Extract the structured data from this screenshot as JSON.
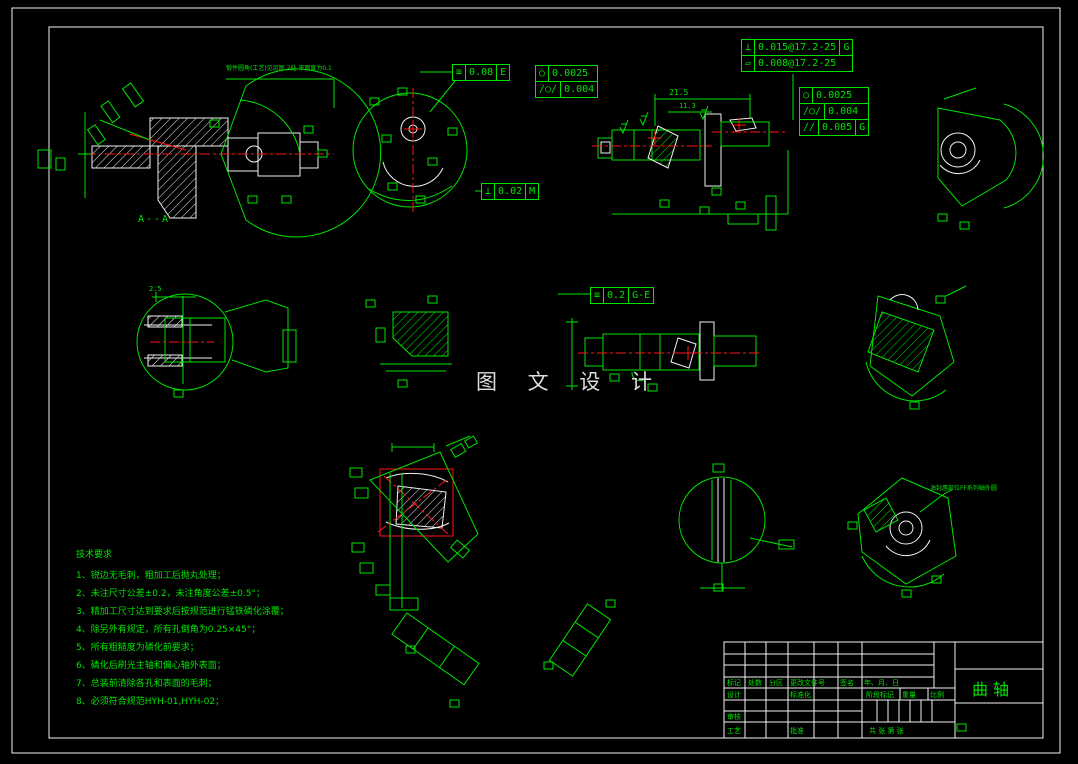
{
  "colors": {
    "background": "#000000",
    "sheet_frame": "#ffffff",
    "line_green": "#00e400",
    "accent_red": "#ff1414",
    "detail_white": "#f2f2f2",
    "watermark_gray": "#dedede"
  },
  "watermark": {
    "text": "图 文 设 计"
  },
  "labels": {
    "section": "A--A"
  },
  "dims": {
    "d1": "21.5",
    "d2": "11.3",
    "d3": "2.5"
  },
  "annotations": {
    "forging_note": "锻件圆角(工艺)见另图 2处 平面度为0.1",
    "seal_note": "油封唇部位FF系列轴外圆"
  },
  "tolerance_frames": {
    "sym008": {
      "symbol": "≡",
      "value": "0.08",
      "datum": "E"
    },
    "perp002": {
      "symbol": "⊥",
      "value": "0.02",
      "datum": "M"
    },
    "circ1": {
      "symbol": "○",
      "value": "0.0025"
    },
    "cyl1": {
      "symbol": "/○/",
      "value": "0.004"
    },
    "perp0015": {
      "symbol": "⊥",
      "value": "0.015@17.2-25",
      "datum": "G"
    },
    "flat0008": {
      "symbol": "▱",
      "value": "0.008@17.2-25"
    },
    "circ2": {
      "symbol": "○",
      "value": "0.0025"
    },
    "cyl2": {
      "symbol": "/○/",
      "value": "0.004"
    },
    "par0005": {
      "symbol": "//",
      "value": "0.005",
      "datum": "G"
    },
    "sym02": {
      "symbol": "≡",
      "value": "0.2",
      "datum": "G-E"
    }
  },
  "tech_requirements": {
    "title": "技术要求",
    "items": [
      "1、锐边无毛刺，粗加工后抛丸处理；",
      "2、未注尺寸公差±0.2，未注角度公差±0.5°；",
      "3、精加工尺寸达到要求后按规范进行锰铁磷化涂覆；",
      "4、除另外有规定，所有孔倒角为0.25×45°；",
      "5、所有粗糙度为磷化前要求；",
      "6、磷化后刷光主轴和偏心轴外表面；",
      "7、总装前清除各孔和表面的毛刺；",
      "8、必须符合规范HYH-01,HYH-02；"
    ]
  },
  "title_block": {
    "part_name": "曲轴",
    "rev_headers": [
      "标记",
      "处数",
      "分区",
      "更改文件号",
      "签名",
      "年、月、日"
    ],
    "roles": {
      "design": "设计",
      "standardization": "标准化",
      "review": "审核",
      "process": "工艺",
      "approve": "批准"
    },
    "fields": {
      "stage_mark": "阶段标记",
      "weight": "重量",
      "scale": "比例",
      "sheet_info": "共  张  第  张"
    }
  }
}
